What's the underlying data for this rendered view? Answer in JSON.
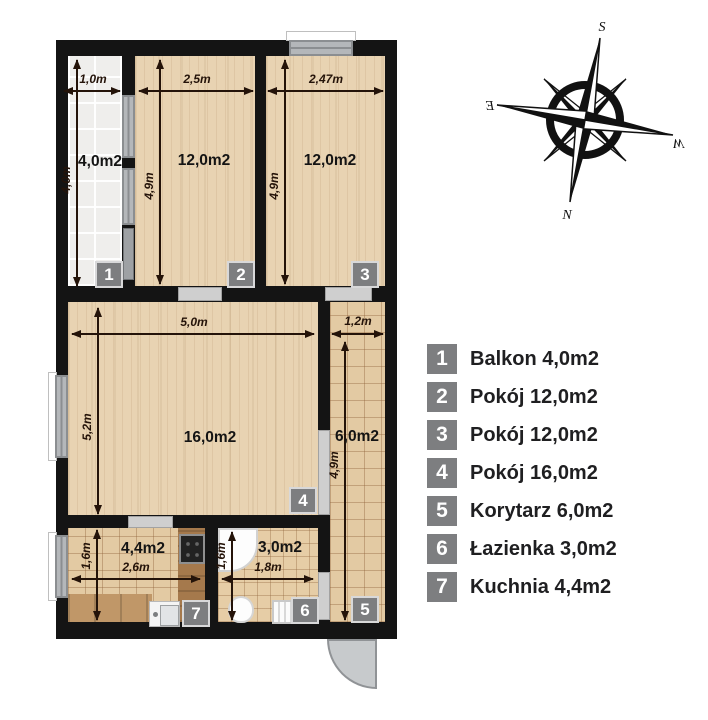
{
  "compass": {
    "s": "S",
    "e": "E",
    "w": "W",
    "n": "N"
  },
  "legend": {
    "items": [
      {
        "num": "1",
        "label": "Balkon 4,0m2"
      },
      {
        "num": "2",
        "label": "Pokój 12,0m2"
      },
      {
        "num": "3",
        "label": "Pokój 12,0m2"
      },
      {
        "num": "4",
        "label": "Pokój 16,0m2"
      },
      {
        "num": "5",
        "label": "Korytarz 6,0m2"
      },
      {
        "num": "6",
        "label": "Łazienka 3,0m2"
      },
      {
        "num": "7",
        "label": "Kuchnia 4,4m2"
      }
    ]
  },
  "rooms": {
    "balkon": {
      "num": "1",
      "area": "4,0m2",
      "w": "1,0m",
      "h": "4,0m"
    },
    "pokoj2": {
      "num": "2",
      "area": "12,0m2",
      "w": "2,5m",
      "h": "4,9m"
    },
    "pokoj3": {
      "num": "3",
      "area": "12,0m2",
      "w": "2,47m",
      "h": "4,9m"
    },
    "pokoj4": {
      "num": "4",
      "area": "16,0m2",
      "w": "5,0m",
      "h": "5,2m"
    },
    "korytarz": {
      "num": "5",
      "area": "6,0m2",
      "w": "1,2m",
      "h": "4,9m"
    },
    "lazienka": {
      "num": "6",
      "area": "3,0m2",
      "w": "1,8m",
      "h": "1,6m"
    },
    "kuchnia": {
      "num": "7",
      "area": "4,4m2",
      "w": "2,6m",
      "h": "1,6m"
    }
  },
  "colors": {
    "wall": "#141414",
    "badge_gray": "#7d7e80",
    "wood_floor": "#e8d3b2",
    "tile_floor": "#e3caa3",
    "balcony_tile": "#efeeec",
    "window_gray": "#b4b7ba",
    "arrow": "#241309",
    "door_swing": "#c7cacc"
  }
}
